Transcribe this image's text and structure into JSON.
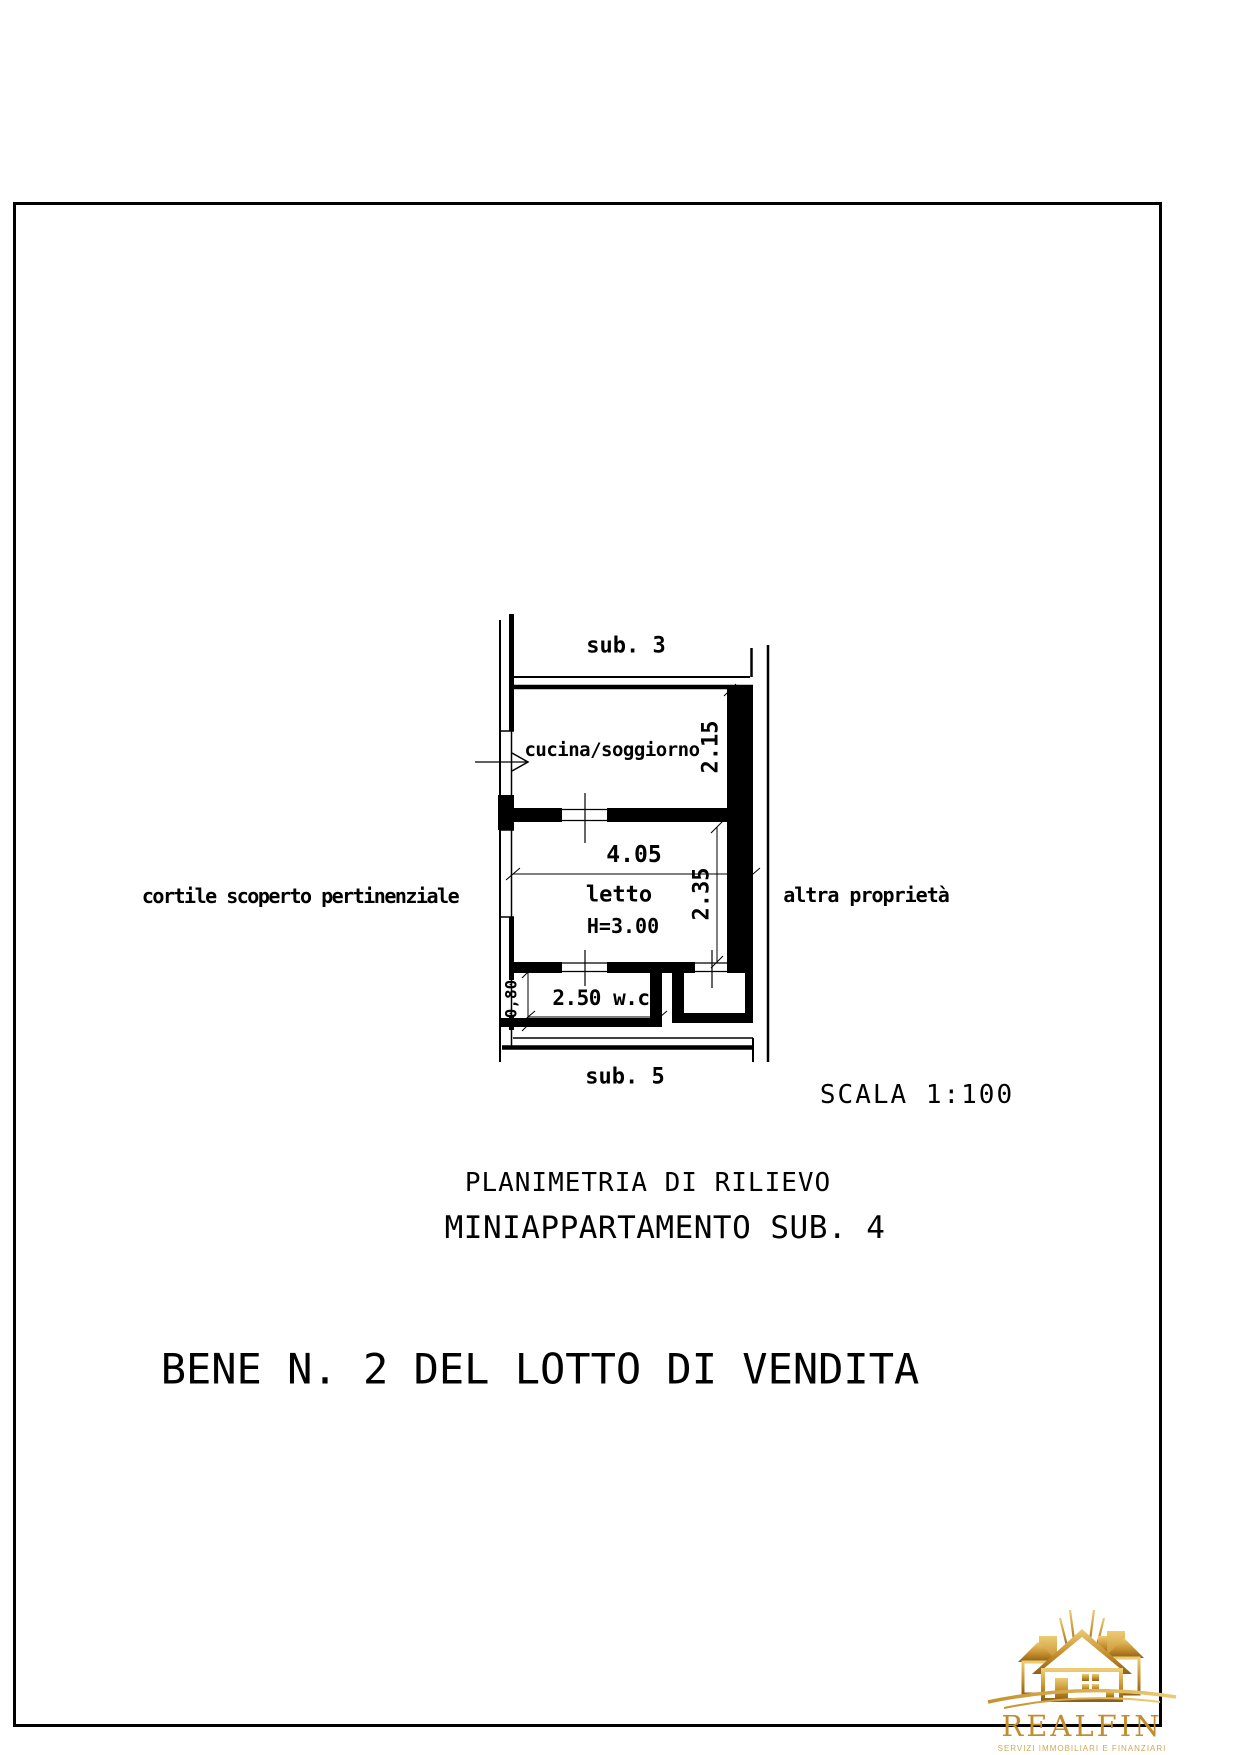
{
  "page": {
    "background": "#ffffff",
    "frame_color": "#000000",
    "ink_color": "#000000"
  },
  "floor_plan": {
    "context_labels": {
      "top_unit": "sub. 3",
      "bottom_unit": "sub. 5",
      "left_area": "cortile scoperto pertinenziale",
      "right_area": "altra proprietà"
    },
    "room_labels": {
      "kitchen_living": "cucina/soggiorno",
      "bedroom": "letto",
      "bedroom_ceiling_height": "H=3.00",
      "wc": "2.50 w.c."
    },
    "dimensions": {
      "kitchen_depth_m": "2.15",
      "bedroom_width_m": "4.05",
      "bedroom_depth_m": "2.35",
      "wc_strip_depth_m": "0,80"
    },
    "scale_label": "SCALA 1:100"
  },
  "captions": {
    "subtitle_line1": "PLANIMETRIA DI RILIEVO",
    "subtitle_line2": "MINIAPPARTAMENTO SUB. 4",
    "main_title": "BENE N. 2 DEL LOTTO DI VENDITA"
  },
  "logo": {
    "brand": "REALFIN",
    "tagline": "SERVIZI IMMOBILIARI E FINANZIARI",
    "gold_light": "#EDCB74",
    "gold_mid": "#C6912F",
    "gold_dark": "#8F6018"
  }
}
